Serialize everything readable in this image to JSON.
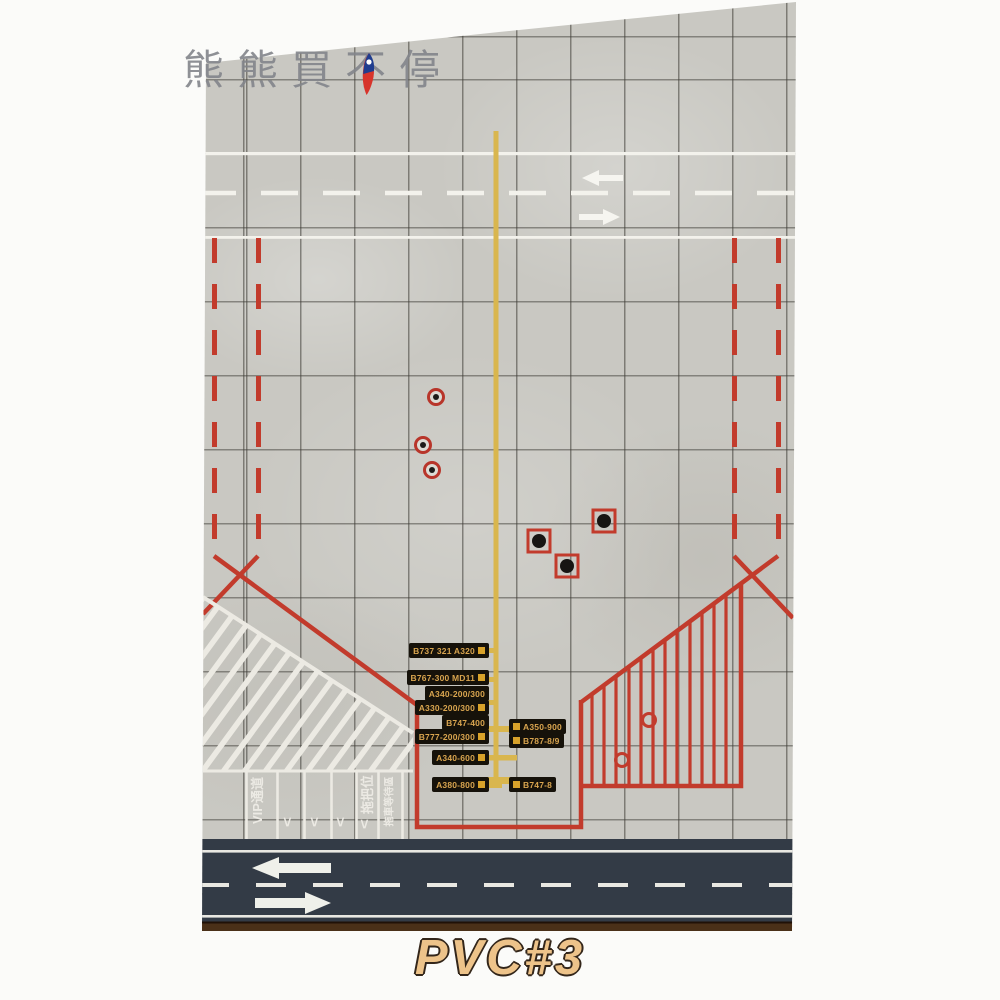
{
  "watermark": {
    "text": "熊熊買不停",
    "icon": "taiwan-flag-icon"
  },
  "product_label": "PVC#3",
  "colors": {
    "mat_gray": "#c9c8c2",
    "grid_line": "#3e3c36",
    "marking_red": "#c23b2c",
    "marking_yellow": "#d9b64e",
    "marking_white": "#eceae3",
    "road_dark": "#333b46",
    "label_bg": "#16120a",
    "label_text": "#d9a54f",
    "label_square_gold": "#d8a22a",
    "mat_edge_brown": "#4a3018",
    "pvc_text": "#edc38a",
    "watermark_gray": "#83858b"
  },
  "stands": {
    "left": [
      {
        "text": "B737 321 A320",
        "square": true
      },
      {
        "text": "B767-300 MD11",
        "square": true
      },
      {
        "text": "A340-200/300",
        "square": false
      },
      {
        "text": "A330-200/300",
        "square": true
      },
      {
        "text": "B747-400",
        "square": false
      },
      {
        "text": "B777-200/300",
        "square": true
      },
      {
        "text": "A340-600",
        "square": true
      },
      {
        "text": "A380-800",
        "square": true
      }
    ],
    "right": [
      {
        "text": "A350-900",
        "square": true
      },
      {
        "text": "B787-8/9",
        "square": true
      },
      {
        "text": "B747-8",
        "square": true
      }
    ]
  },
  "lanes": {
    "vip": "VIP通道",
    "tow_bar": "拖把位",
    "tow_wait": "拖車等待區",
    "chevron": "<"
  }
}
